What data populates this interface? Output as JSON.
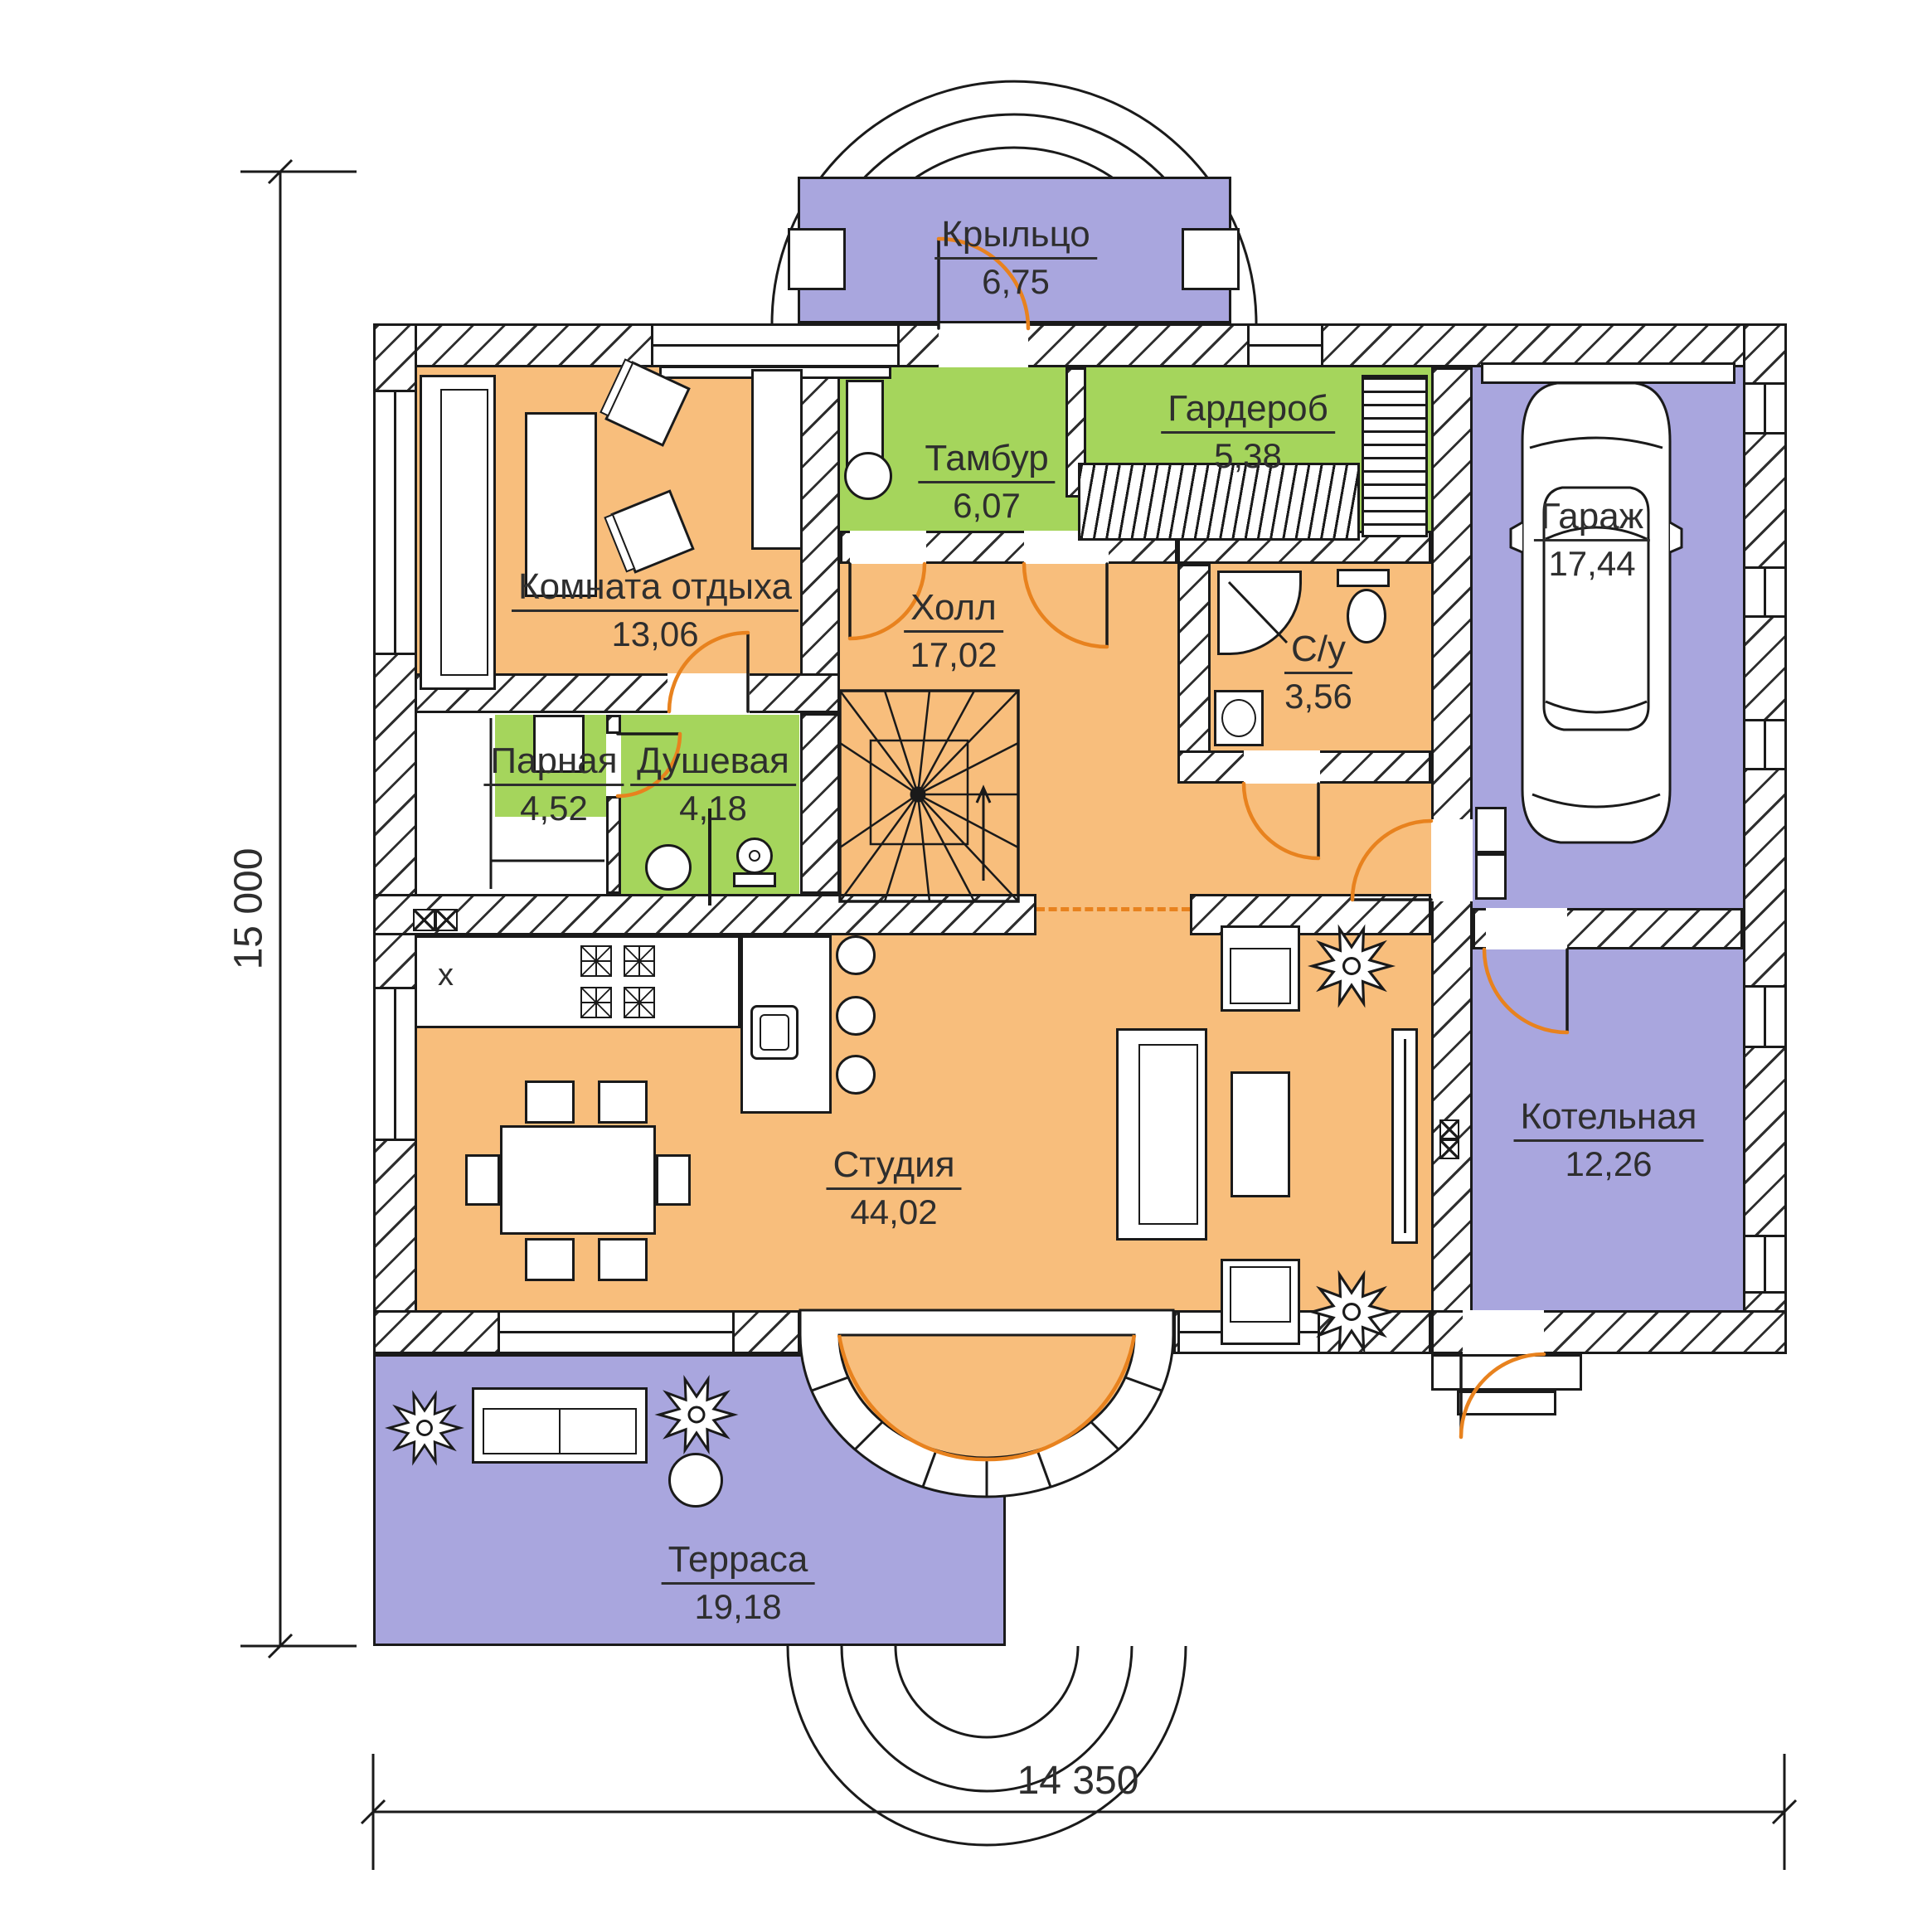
{
  "plan": {
    "type": "floor-plan",
    "language": "ru",
    "rooms": [
      {
        "name": "Крыльцо",
        "area": "6,75"
      },
      {
        "name": "Тамбур",
        "area": "6,07"
      },
      {
        "name": "Гардероб",
        "area": "5,38"
      },
      {
        "name": "Комната отдыха",
        "area": "13,06"
      },
      {
        "name": "Холл",
        "area": "17,02"
      },
      {
        "name": "С/у",
        "area": "3,56"
      },
      {
        "name": "Парная",
        "area": "4,52"
      },
      {
        "name": "Душевая",
        "area": "4,18"
      },
      {
        "name": "Гараж",
        "area": "17,44"
      },
      {
        "name": "Студия",
        "area": "44,02"
      },
      {
        "name": "Котельная",
        "area": "12,26"
      },
      {
        "name": "Терраса",
        "area": "19,18"
      }
    ],
    "dimensions": {
      "left": "15 000",
      "bottom": "14 350"
    },
    "annotations": {
      "kitchen_sink_mark": "x"
    },
    "colors": {
      "room_orange": "#F8BE7C",
      "room_green": "#A5D55C",
      "room_purple": "#A9A6DE",
      "door_arc": "#E8821E",
      "line": "#1a1a1a"
    }
  }
}
